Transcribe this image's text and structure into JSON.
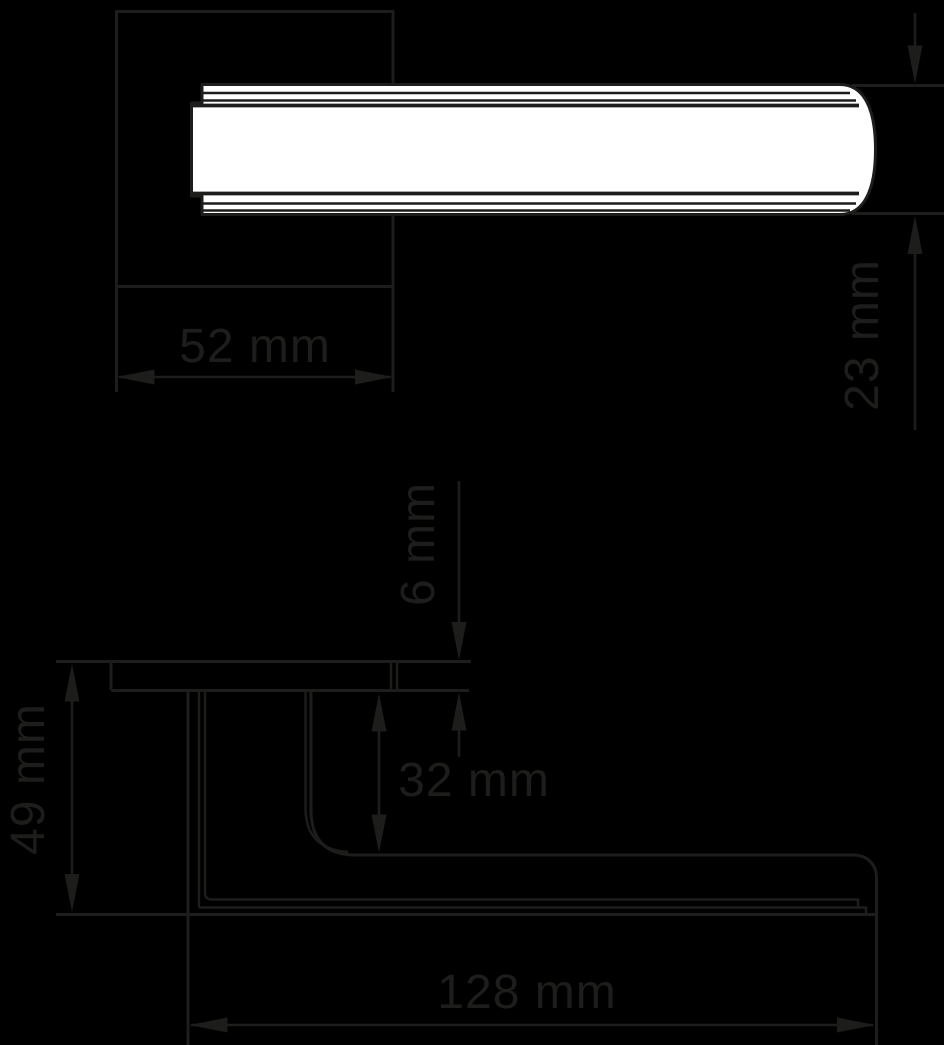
{
  "page": {
    "background_color": "#000000"
  },
  "diagram": {
    "type": "technical-dimension-drawing",
    "subject": "door lever handle on square rose, front view (top) and side profile view (bottom)",
    "line_color": "#1d1d1b",
    "fill_color": "#ffffff",
    "views": [
      {
        "id": "front",
        "name": "front view: lever bar over square rose"
      },
      {
        "id": "side",
        "name": "side view: rose, neck and lever projection"
      }
    ],
    "dimensions": [
      {
        "id": "rose-width",
        "label": "52 mm",
        "orientation": "horizontal",
        "view": "front"
      },
      {
        "id": "lever-bar-height",
        "label": "23 mm",
        "orientation": "vertical",
        "view": "front"
      },
      {
        "id": "rose-thickness",
        "label": "6 mm",
        "orientation": "vertical",
        "view": "side"
      },
      {
        "id": "rose-to-lever-clearance",
        "label": "32 mm",
        "orientation": "vertical",
        "view": "side"
      },
      {
        "id": "total-projection",
        "label": "49 mm",
        "orientation": "vertical",
        "view": "side"
      },
      {
        "id": "lever-length",
        "label": "128 mm",
        "orientation": "horizontal",
        "view": "side"
      }
    ]
  }
}
